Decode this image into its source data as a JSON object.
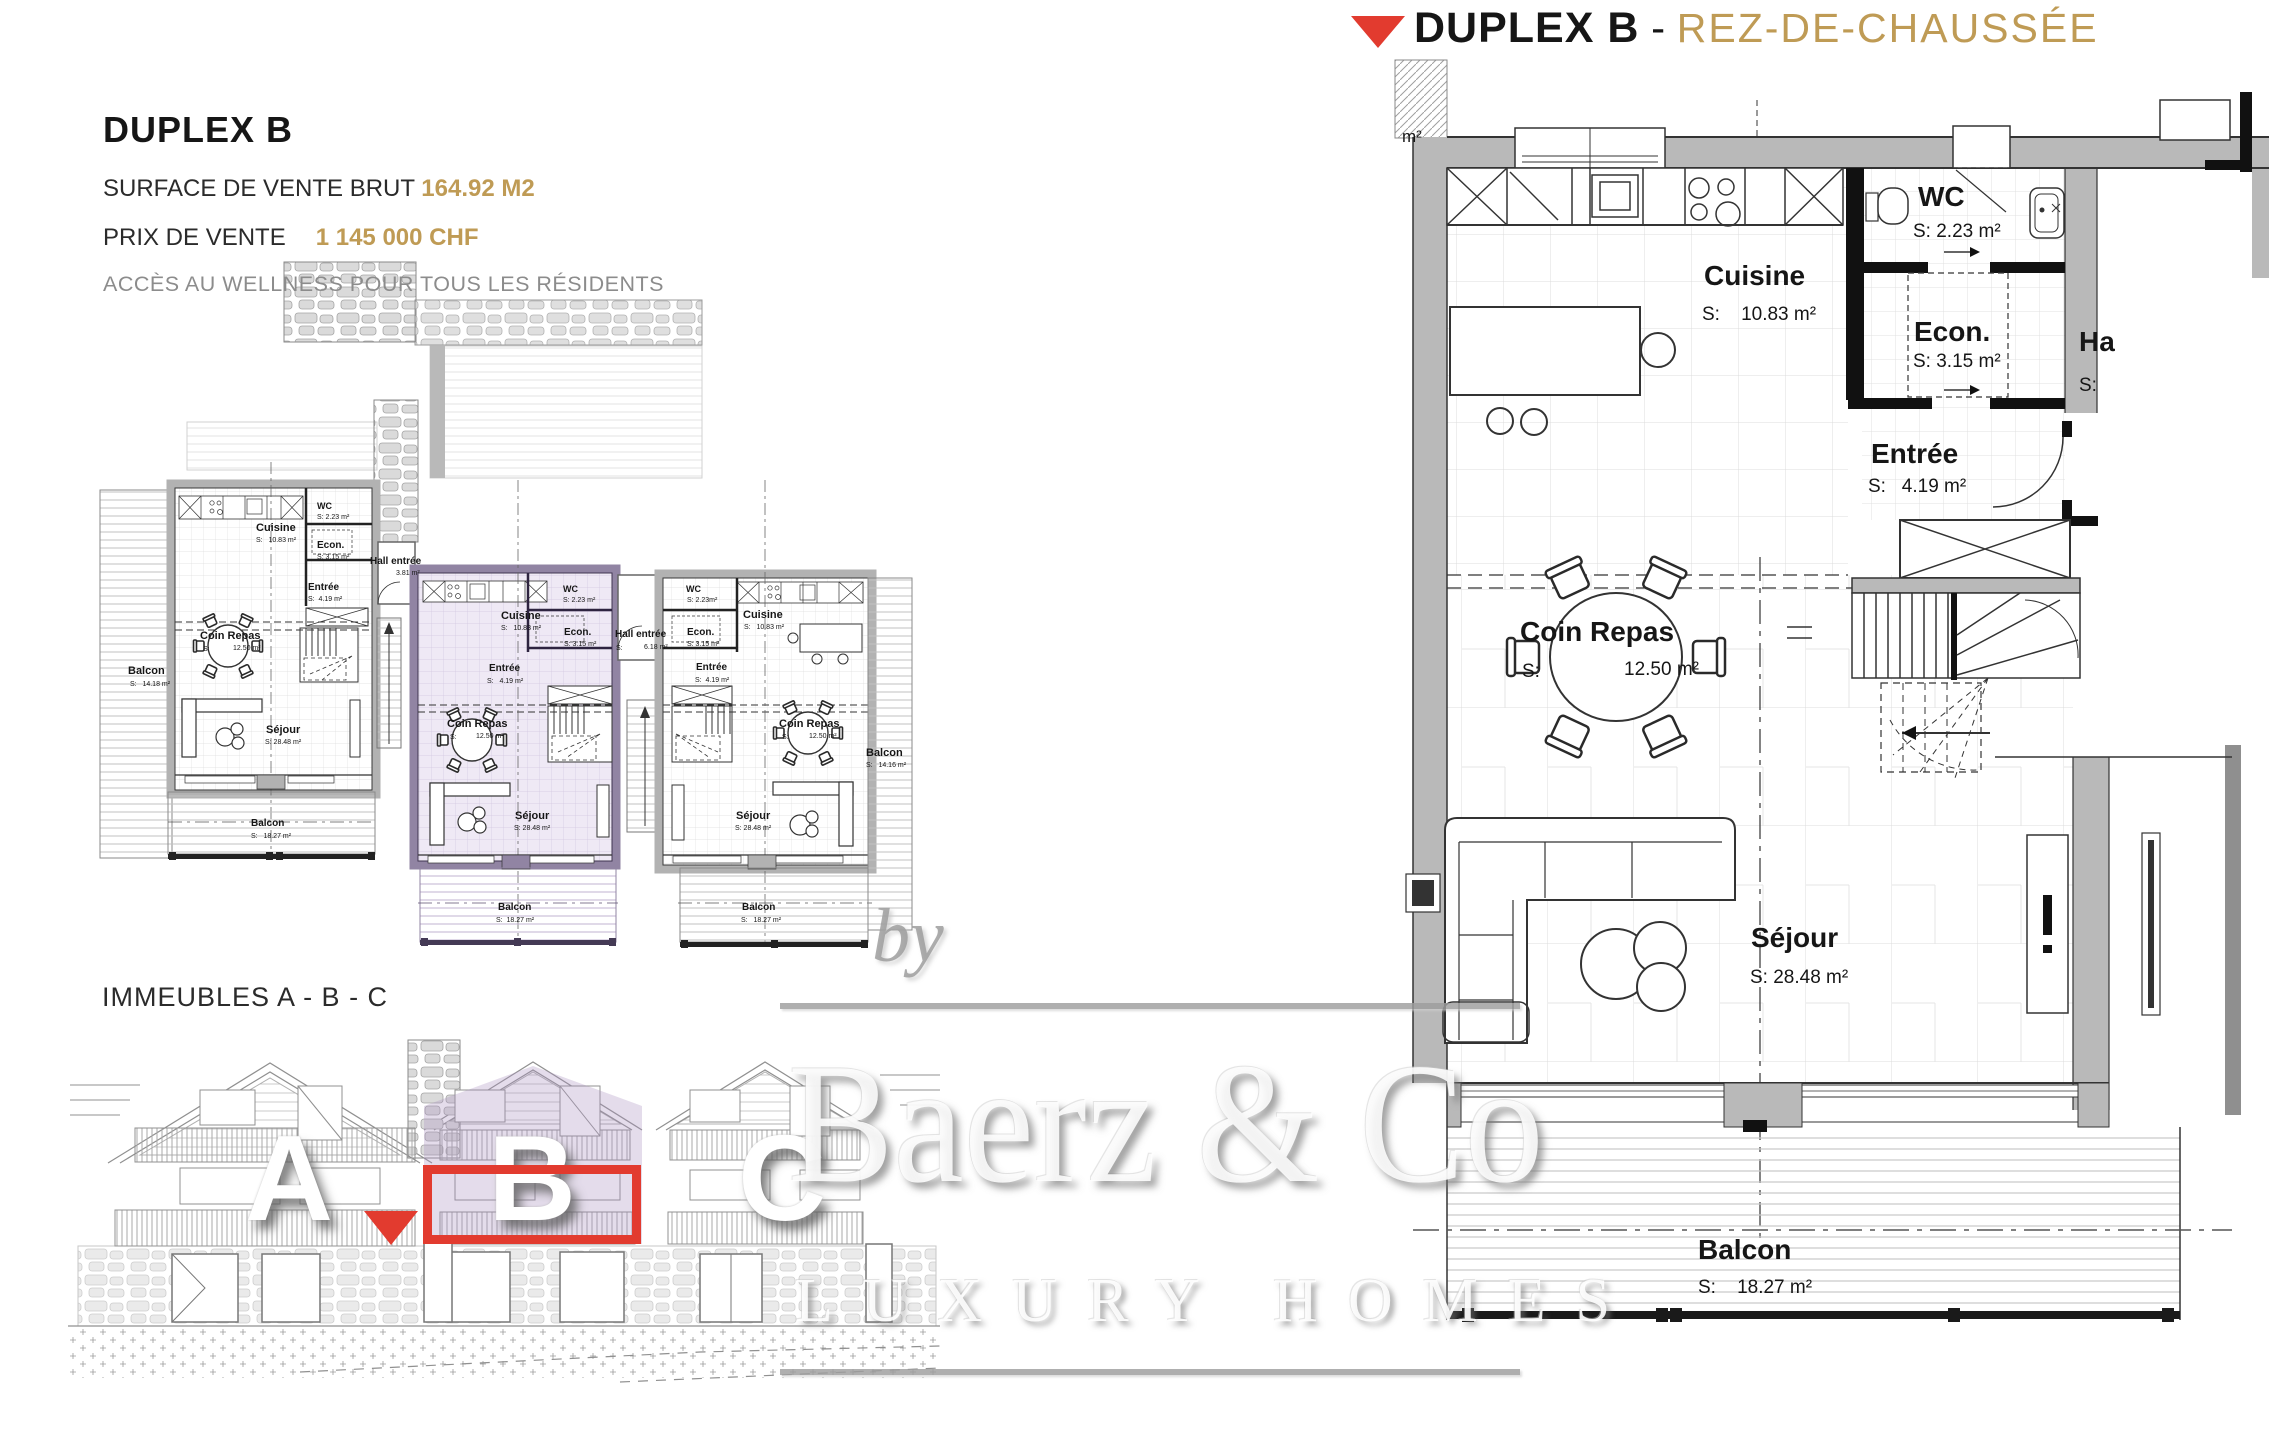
{
  "header": {
    "title": "DUPLEX B",
    "separator": " - ",
    "subtitle": "REZ-DE-CHAUSSÉE"
  },
  "info": {
    "title": "DUPLEX B",
    "surface_label": "SURFACE DE VENTE BRUT",
    "surface_value": "164.92 M2",
    "price_label": "PRIX DE VENTE",
    "price_value": "1 145 000 CHF",
    "wellness_note": "ACCÈS AU WELLNESS POUR TOUS LES RÉSIDENTS"
  },
  "section_label": "IMMEUBLES A - B - C",
  "buildings": {
    "a": "A",
    "b": "B",
    "c": "C"
  },
  "watermark": {
    "by": "by",
    "brand": "Baerz & Co",
    "tagline": "LUXURY HOMES"
  },
  "main_plan": {
    "partial_area_unit": "m²",
    "rooms": {
      "cuisine": {
        "name": "Cuisine",
        "area": "S:    10.83 m²"
      },
      "wc": {
        "name": "WC",
        "area": "S: 2.23 m²"
      },
      "econ": {
        "name": "Econ.",
        "area": "S: 3.15 m²"
      },
      "hall": {
        "name": "Ha",
        "area": "S:"
      },
      "entree": {
        "name": "Entrée",
        "area": "S:   4.19 m²"
      },
      "coin_repas": {
        "name": "Coin Repas",
        "s": "S:",
        "area": "12.50 m²"
      },
      "sejour": {
        "name": "Séjour",
        "area": "S: 28.48 m²"
      },
      "balcon": {
        "name": "Balcon",
        "area": "S:    18.27 m²"
      }
    }
  },
  "small_plan": {
    "left": {
      "cuisine": "Cuisine",
      "cuisine_area": "S:   10.83 m²",
      "wc": "WC",
      "wc_area": "S: 2.23 m²",
      "econ": "Econ.",
      "econ_area": "S: 3.15 m²",
      "entree": "Entrée",
      "entree_area": "S:  4.19 m²",
      "hall": "Hall entrée",
      "hall_area": "3.81 m²",
      "coin": "Coin Repas",
      "coin_s": "S:",
      "coin_area": "12.50 m²",
      "sejour": "Séjour",
      "sejour_area": "S: 28.48 m²",
      "balcon_side": "Balcon",
      "balcon_side_area": "S:   14.18 m²",
      "balcon": "Balcon",
      "balcon_area": "S:   18.27 m²"
    },
    "middle": {
      "cuisine": "Cuisine",
      "cuisine_area": "S:   10.83 m²",
      "wc": "WC",
      "wc_area": "S: 2.23 m²",
      "econ": "Econ.",
      "econ_area": "S: 3.15 m²",
      "hall": "Hall entrée",
      "hall_s": "S:",
      "hall_area": "6.18 m²",
      "entree": "Entrée",
      "entree_area": "S:   4.19 m²",
      "coin": "Coin Repas",
      "coin_s": "S:",
      "coin_area": "12.50 m²",
      "sejour": "Séjour",
      "sejour_area": "S: 28.48 m²",
      "balcon": "Balcon",
      "balcon_area": "S:  18.27 m²"
    },
    "right": {
      "wc": "WC",
      "wc_area": "S: 2.23m²",
      "cuisine": "Cuisine",
      "cuisine_area": "S:   10.83 m²",
      "econ": "Econ.",
      "econ_area": "S: 3.15 m²",
      "entree": "Entrée",
      "entree_area": "S:  4.19 m²",
      "coin": "Coin Repas",
      "coin_s": "S:",
      "coin_area": "12.50 m²",
      "sejour": "Séjour",
      "sejour_area": "S: 28.48 m²",
      "balcon_side": "Balcon",
      "balcon_side_area": "S:   14.16 m²",
      "balcon": "Balcon",
      "balcon_area": "S:   18.27 m²"
    }
  }
}
